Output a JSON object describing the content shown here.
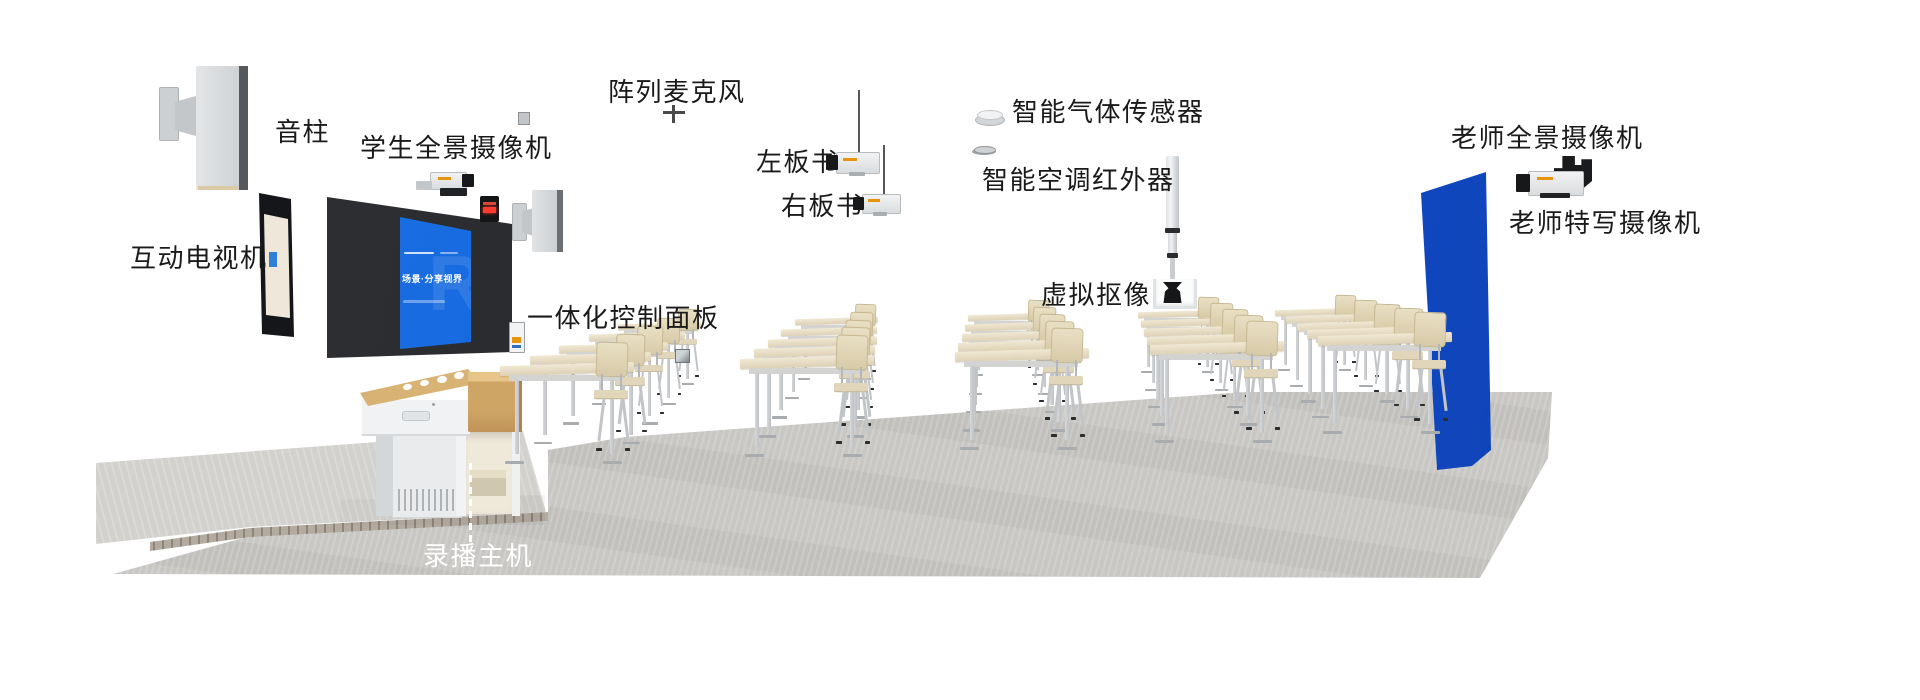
{
  "labels": {
    "speaker_column": "音柱",
    "student_panorama_camera": "学生全景摄像机",
    "interactive_tv": "互动电视机",
    "array_microphone": "阵列麦克风",
    "left_board_camera": "左板书",
    "right_board_camera": "右板书",
    "gas_sensor": "智能气体传感器",
    "ac_infrared": "智能空调红外器",
    "virtual_keying": "虚拟抠像",
    "teacher_panorama_camera": "老师全景摄像机",
    "teacher_closeup_camera": "老师特写摄像机",
    "control_panel": "一体化控制面板",
    "recording_host": "录播主机"
  },
  "display_screen": {
    "slogan": "场景·分享视界",
    "watermark": "R"
  },
  "colors": {
    "chroma_key_blue": "#1550cf",
    "display_screen_blue": "#1668dd",
    "label_text": "#1a1a1a",
    "recording_host_label": "#ffffff",
    "camera_accent_orange": "#e8930c"
  }
}
